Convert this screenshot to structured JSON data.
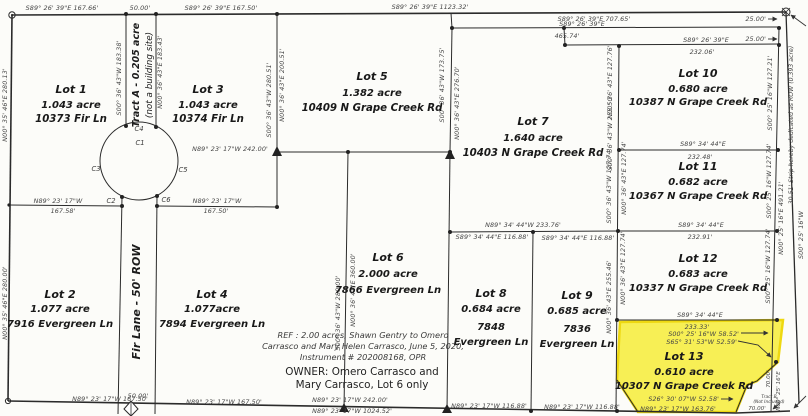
{
  "map": {
    "colors": {
      "highlight": "#f7ef4d",
      "highlight_edge": "#eed705",
      "line": "#2b2b2b",
      "dim_text": "#454545",
      "paper": "#fcfcf9"
    },
    "lots": {
      "lot1": {
        "name": "Lot 1",
        "area": "1.043 acre",
        "address": "10373 Fir Ln"
      },
      "lot2": {
        "name": "Lot 2",
        "area": "1.077 acre",
        "address": "7916 Evergreen Ln"
      },
      "lot3": {
        "name": "Lot 3",
        "area": "1.043 acre",
        "address": "10374 Fir Ln"
      },
      "lot4": {
        "name": "Lot 4",
        "area": "1.077acre",
        "address": "7894 Evergreen Ln"
      },
      "lot5": {
        "name": "Lot 5",
        "area": "1.382 acre",
        "address": "10409 N Grape Creek Rd"
      },
      "lot6": {
        "name": "Lot 6",
        "area": "2.000 acre",
        "address": "7866 Evergreen Ln"
      },
      "lot7": {
        "name": "Lot 7",
        "area": "1.640 acre",
        "address": "10403 N Grape Creek Rd"
      },
      "lot8": {
        "name": "Lot 8",
        "area": "0.684 acre",
        "addr1": "7848",
        "addr2": "Evergreen Ln"
      },
      "lot9": {
        "name": "Lot 9",
        "area": "0.685 acre",
        "addr1": "7836",
        "addr2": "Evergreen Ln"
      },
      "lot10": {
        "name": "Lot 10",
        "area": "0.680 acre",
        "address": "10387 N Grape Creek Rd"
      },
      "lot11": {
        "name": "Lot 11",
        "area": "0.682 acre",
        "address": "10367 N Grape Creek Rd"
      },
      "lot12": {
        "name": "Lot 12",
        "area": "0.683 acre",
        "address": "10337 N Grape Creek Rd"
      },
      "lot13": {
        "name": "Lot 13",
        "area": "0.610 acre",
        "address": "10307 N Grape Creek Rd"
      },
      "tract_a": {
        "line1": "Tract A - 0.205 acre",
        "line2": "(not a building site)"
      },
      "tract_b": {
        "line1": "Tract B",
        "line2": "(Not Included)"
      }
    },
    "road": {
      "fir_lane": "Fir Lane - 50' ROW"
    },
    "strip": {
      "label": "30.51' Strip hereby dedicated as ROW (0.393 acre)"
    },
    "curves": {
      "c1": "C1",
      "c2": "C2",
      "c3": "C3",
      "c4": "C4",
      "c5": "C5",
      "c6": "C6"
    },
    "notes": {
      "ref1": "REF : 2.00 acres, Shawn Gentry to Omero",
      "ref2": "Carrasco and Mary Helen Carrasco, June 5, 2020,",
      "ref3": "Instrument # 202008168, OPR",
      "owner1": "OWNER: Omero Carrasco and",
      "owner2": "Mary Carrasco, Lot 6 only"
    },
    "dims": {
      "t1": "S89° 26' 39\"E  167.66'",
      "t2": "50.00'",
      "t3": "S89° 26' 39\"E  167.50'",
      "t4": "S89° 26' 39\"E  1123.32'",
      "t5": "S89° 26' 39\"E  707.65'",
      "t6a": "S89° 26' 39\"E",
      "t6b": "465.74'",
      "t7a": "S89° 26' 39\"E",
      "t7b": "232.06'",
      "t8": "25.00'",
      "t9": "25.00'",
      "w1": "N00° 35' 46\"E  280.13'",
      "w2": "N00° 35' 46\"E  280.00'",
      "ta_w": "S00° 36' 43\"W  183.38'",
      "ta_e": "N00° 36' 43\"E  183.43'",
      "v35_w": "S00° 36' 43\"W  280.51'",
      "v35_e": "N00° 36' 43\"E  200.51'",
      "v57_w": "S00° 36' 43\"W  173.75'",
      "v57_e": "N00° 36' 43\"E  276.70'",
      "lot5_s": "N89° 23' 17\"W  242.00'",
      "v46_w": "S00° 36' 43\"W  280.00'",
      "v46_e": "N00° 36' 43\"E  360.00'",
      "cds_w1": "N89° 23' 17\"W",
      "cds_w2": "167.58'",
      "cds_e1": "N89° 23' 17\"W",
      "cds_e2": "167.50'",
      "v619_a": "N00° 36' 43\"E  127.76'",
      "v619_b": "S00° 36' 43\"W  255.50'",
      "v619_c": "S00° 36' 43\"W  127.74'",
      "v619_d": "N00° 36' 43\"E  127.74'",
      "v619_e": "N00° 36' 43\"E  127.74'",
      "v619_f": "N00° 36' 43\"E  255.46'",
      "lot7_s": "N89° 34' 44\"W  233.76'",
      "lot8_n": "S89° 34' 44\"E  116.88'",
      "lot9_n": "S89° 34' 44\"E  116.88'",
      "l10b1": "S89° 34' 44\"E",
      "l10b2": "232.48'",
      "l11b1": "S89° 34' 44\"E",
      "l11b2": "232.91'",
      "l12b1": "S89° 34' 44\"E",
      "l13t": "233.33'",
      "l13e1": "S00° 25' 16\"W  58.52'",
      "l13e2": "S65° 31' 53\"W  52.59'",
      "l13s1": "S26° 30' 07\"W  52.58'",
      "l13s2": "N89° 23' 17\"W  163.76'",
      "e10": "S00° 25' 16\"W  127.21'",
      "e11": "S00° 25' 16\"W  127.74'",
      "e12": "S00° 25' 16\"W  127.74'",
      "e491": "N00° 25' 16\"E  491.21'",
      "e_outer": "S00° 25' 16\"W",
      "e70a": "70.00'",
      "e70b": "N00° 25' 16\"E",
      "tb70": "70.00'",
      "b1": "N89° 23' 17\"W  167.50'",
      "b2": "50.00'",
      "b3": "N89° 23' 17\"W  167.50'",
      "b4": "N89° 23' 17\"W  242.00'",
      "b5": "N89° 23' 17\"W  1024.52'",
      "b6": "N89° 23' 17\"W  116.88'",
      "b7": "N89° 23' 17\"W  116.88'"
    }
  }
}
